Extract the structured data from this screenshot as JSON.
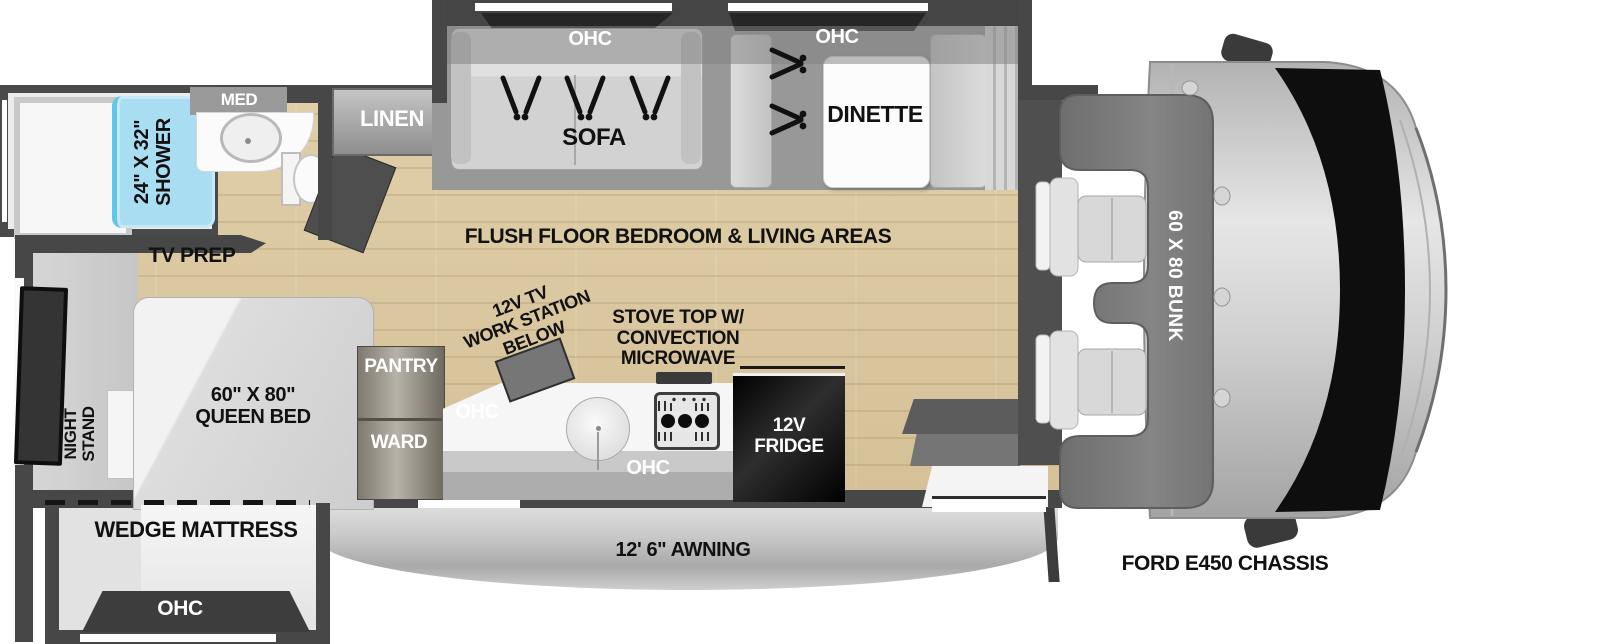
{
  "colors": {
    "wall": "#474747",
    "floor_wood": "#d9c7a0",
    "slide_gray": "#989898",
    "shower_blue": "#a9ddf1",
    "fridge_black": "#111111",
    "awning_gray": "#c6c6c6",
    "bunk_gray": "#7a7a7a"
  },
  "labels": {
    "top_slide": {
      "ohc_sofa": "OHC",
      "sofa": "SOFA",
      "ohc_dinette": "OHC",
      "dinette": "DINETTE"
    },
    "bathroom": {
      "med": "MED",
      "shower": "24\" X 32\"\nSHOWER",
      "linen": "LINEN",
      "tv_prep": "TV PREP"
    },
    "bedroom": {
      "night_stand": "NIGHT\nSTAND",
      "queen_bed": "60\" X 80\"\nQUEEN BED",
      "wedge_mattress": "WEDGE MATTRESS",
      "ohc": "OHC"
    },
    "kitchen": {
      "pantry": "PANTRY",
      "ward": "WARD",
      "ohc_upper": "OHC",
      "ohc_lower": "OHC",
      "work_station": "12V TV\nWORK STATION\nBELOW",
      "stove": "STOVE TOP W/\nCONVECTION\nMICROWAVE",
      "fridge": "12V\nFRIDGE"
    },
    "main": {
      "flush_floor": "FLUSH FLOOR BEDROOM & LIVING AREAS"
    },
    "cab": {
      "bunk": "60 X 80 BUNK",
      "chassis": "FORD E450 CHASSIS"
    },
    "awning": {
      "label": "12' 6\" AWNING"
    }
  }
}
